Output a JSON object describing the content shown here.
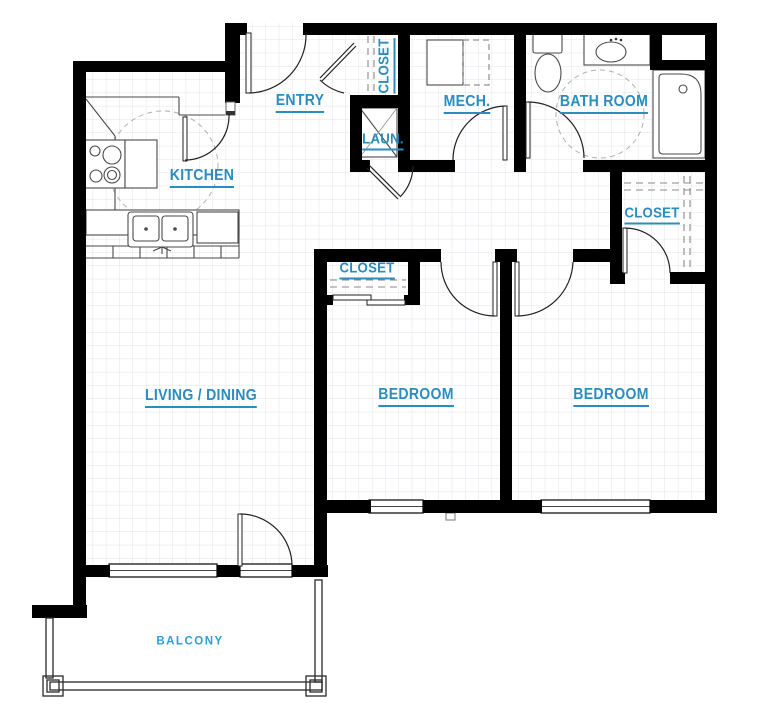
{
  "title": "Two-bedroom apartment floor plan",
  "colors": {
    "label_blue": "#2b8cbe",
    "balcony_blue": "#2e9fd4",
    "wall_black": "#000000",
    "grid_gray": "#dfe3e8"
  },
  "rooms": [
    {
      "id": "kitchen",
      "label": "KITCHEN"
    },
    {
      "id": "entry",
      "label": "ENTRY"
    },
    {
      "id": "entry-closet",
      "label": "CLOSET"
    },
    {
      "id": "laundry",
      "label": "LAUN."
    },
    {
      "id": "mech",
      "label": "MECH."
    },
    {
      "id": "bathroom",
      "label": "BATH ROOM"
    },
    {
      "id": "closet-right-bedroom",
      "label": "CLOSET"
    },
    {
      "id": "closet-left-bedroom",
      "label": "CLOSET"
    },
    {
      "id": "living-dining",
      "label": "LIVING / DINING"
    },
    {
      "id": "bedroom-left",
      "label": "BEDROOM"
    },
    {
      "id": "bedroom-right",
      "label": "BEDROOM"
    },
    {
      "id": "balcony",
      "label": "BALCONY"
    }
  ],
  "fixtures": [
    "stove-icon",
    "kitchen-sink-icon",
    "dishwasher-icon",
    "washer-icon",
    "mech-equipment-icon",
    "toilet-icon",
    "vanity-sink-icon",
    "bathtub-icon",
    "balcony-railing"
  ]
}
